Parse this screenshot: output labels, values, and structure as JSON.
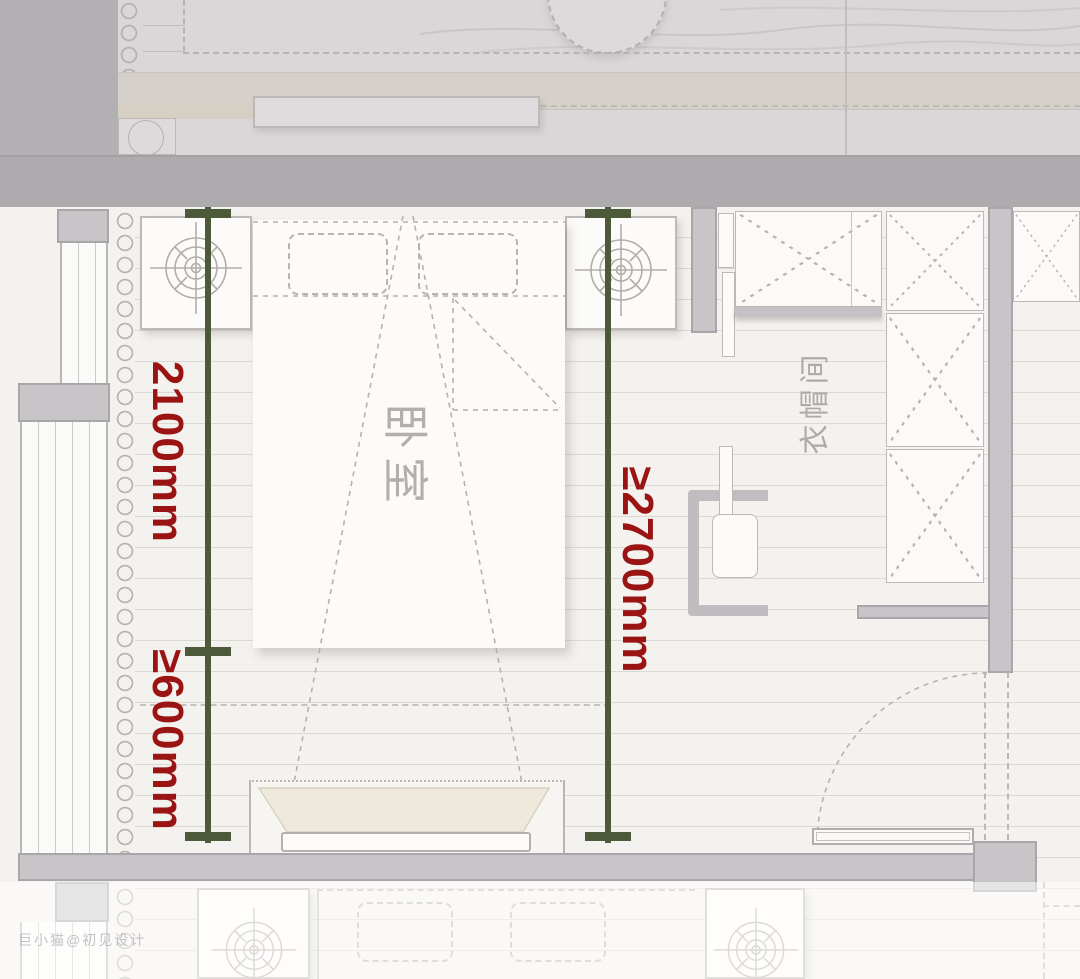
{
  "plan": {
    "type": "bedroom-floor-plan",
    "bed_room_label": "卧室",
    "closet_label": "衣帽间",
    "watermark": "巨小猫@初见设计"
  },
  "annotations": {
    "dim_left_upper": {
      "label": "2100mm",
      "meaning": "bed length zone",
      "orientation": "vertical"
    },
    "dim_left_lower": {
      "label": "≥600mm",
      "meaning": "clearance at bed foot",
      "orientation": "vertical"
    },
    "dim_right": {
      "label": "≥2700mm",
      "meaning": "room depth",
      "orientation": "vertical"
    }
  },
  "colors": {
    "dimension_line": "#4d5a39",
    "dimension_text": "#9a1414",
    "wall_gray": "#c8c5c8",
    "separator_band": "#aeabae",
    "floor_line": "#dcd9d5",
    "label_gray": "#b3b0ac"
  }
}
